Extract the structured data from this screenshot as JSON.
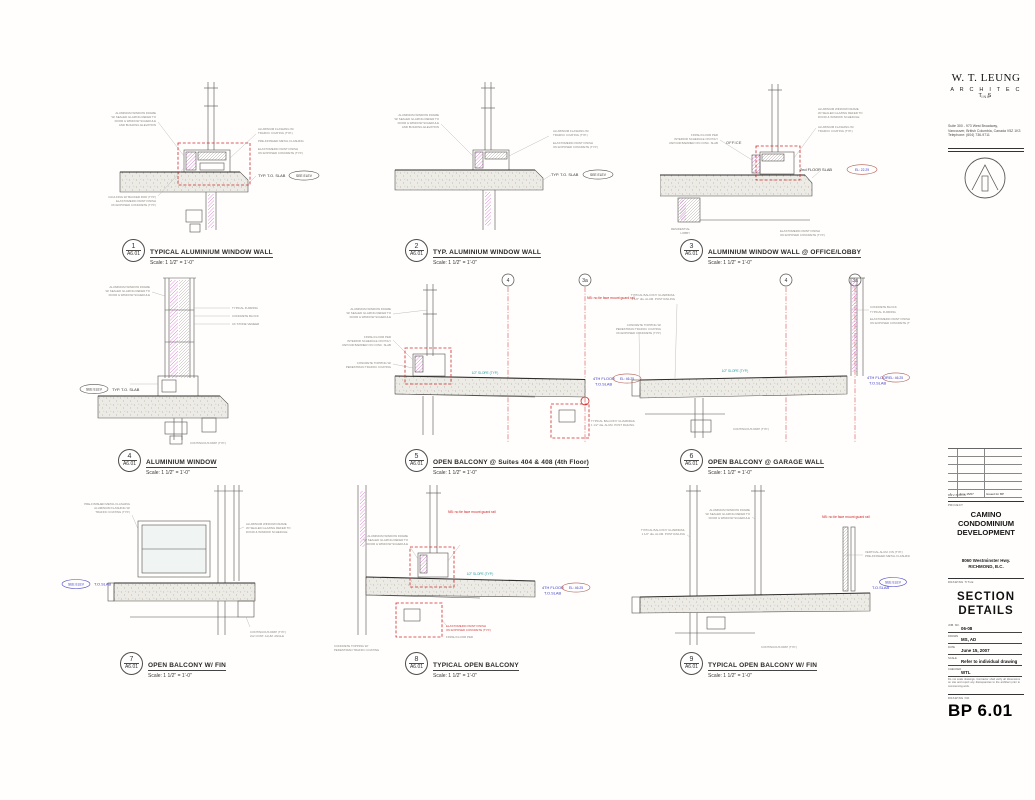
{
  "titleblock": {
    "firm_name": "W. T. LEUNG",
    "firm_sub": "A R C H I T E C T S",
    "firm_inc": "INC",
    "address": [
      "Suite 300 - 973 West Broadway,",
      "Vancouver, British Columbia, Canada V5Z 1K3",
      "Telephone: (604) 736-9711"
    ],
    "revision_row": {
      "no": "1",
      "date": "June 15/07",
      "desc": "Issued for BP"
    },
    "revisions_label": "REVISIONS",
    "project_label": "PROJECT",
    "project_name": [
      "CAMINO",
      "CONDOMINIUM",
      "DEVELOPMENT"
    ],
    "project_address": [
      "8060 Westminster Hwy.",
      "RICHMOND, B.C."
    ],
    "drawing_title_label": "DRAWING TITLE",
    "drawing_title": [
      "SECTION",
      "DETAILS"
    ],
    "fields": [
      {
        "label": "JOB. NO.",
        "value": "06-08"
      },
      {
        "label": "DRAWN",
        "value": "MS, AD"
      },
      {
        "label": "DATE",
        "value": "June 15, 2007"
      },
      {
        "label": "SCALE",
        "value": "Refer to individual drawing"
      },
      {
        "label": "CHECKED",
        "value": "WTL"
      }
    ],
    "disclaimer": "Do not scale drawings. Contractor shall verify all dimensions on site and report any discrepancies to the architect prior to commencing work.",
    "drawing_no_label": "DRAWING NO.",
    "drawing_no": "BP 6.01"
  },
  "details": [
    {
      "number": "1",
      "sheet": "A6.01",
      "title": "TYPICAL ALUMINIUM WINDOW WALL",
      "scale": "Scale: 1 1/2\" = 1'-0\""
    },
    {
      "number": "2",
      "sheet": "A6.01",
      "title": "TYP. ALUMINIUM WINDOW WALL",
      "scale": "Scale: 1 1/2\" = 1'-0\""
    },
    {
      "number": "3",
      "sheet": "A6.01",
      "title": "ALUMINIUM WINDOW WALL @ OFFICE/LOBBY",
      "scale": "Scale: 1 1/2\" = 1'-0\""
    },
    {
      "number": "4",
      "sheet": "A6.01",
      "title": "ALUMINIUM WINDOW",
      "scale": "Scale: 1 1/2\" = 1'-0\""
    },
    {
      "number": "5",
      "sheet": "A6.01",
      "title": "OPEN BALCONY @ Suites 404 & 408 (4th Floor)",
      "scale": "Scale: 1 1/2\" = 1'-0\""
    },
    {
      "number": "6",
      "sheet": "A6.01",
      "title": "OPEN BALCONY @ GARAGE WALL",
      "scale": "Scale: 1 1/2\" = 1'-0\""
    },
    {
      "number": "7",
      "sheet": "A6.01",
      "title": "OPEN BALCONY W/ FIN",
      "scale": "Scale: 1 1/2\" = 1'-0\""
    },
    {
      "number": "8",
      "sheet": "A6.01",
      "title": "TYPICAL OPEN BALCONY",
      "scale": "Scale: 1 1/2\" = 1'-0\""
    },
    {
      "number": "9",
      "sheet": "A6.01",
      "title": "TYPICAL OPEN BALCONY W/ FIN",
      "scale": "Scale: 1 1/2\" = 1'-0\""
    }
  ],
  "tags": {
    "see_elev": "SEE ELEV",
    "typ_to_slab": "TYP. T.O. SLAB",
    "to_slab": "T.O.SLAB",
    "fourth_floor": "4TH FLOOR",
    "el_4625": "EL: 46.25",
    "el_2229": "EL: 22.29",
    "second_floor_slab": "2nd FLOOR SLAB",
    "office": "OFFICE",
    "res_lobby_1": "RESIDENTIAL",
    "res_lobby_2": "LOBBY",
    "nb_note": "NB: no tie face mount guard rail",
    "slope": "1/2\" SLOPE (TYP.)",
    "grid_4": "4",
    "grid_3a": "3a"
  },
  "ann": {
    "a1": "ALUMINIUM WINDOW FRAME",
    "a2": "W/ SEALED GLAZING REFER TO",
    "a3": "DOOR & WINDOW SCHEDULE",
    "a4": "AND BUILDING ELEVATION",
    "b1": "ALUMINIUM FLASHING W/",
    "b2": "TRAFFIC COATING (TYP.)",
    "c1": "ELASTOMERIC PAINT FINISH",
    "c2": "ON EXPOSED CONCRETE (TYP.)",
    "d1": "CAULKING W/ BACKER ROD (TYP.)",
    "e1": "PRE-FINISHED METAL FLASHING",
    "f1": "FINISH FLOOR PER",
    "f2": "INTERIOR SCHEDULE ON POLY",
    "f3": "VAPOUR BARRIER ON CONC. SLAB",
    "g1": "TYPICAL BALCONY GUARDRAIL",
    "g2": "1 1/2\" dia. ALUM. POST RAILING",
    "h1": "CONTINUOUS DRIP (TYP.)",
    "i1": "CF STONE VENEER",
    "i2": "CONCRETE BLOCK",
    "i3": "TYPICAL FURRING",
    "j1": "2x2 CONT. ALUM. ANGLE",
    "k1": "CONCRETE TOPPING W/",
    "k2": "PEDESTRIAN TRAFFIC COATING",
    "m1": "VERTICAL ALUM. FIN (TYP.)"
  }
}
